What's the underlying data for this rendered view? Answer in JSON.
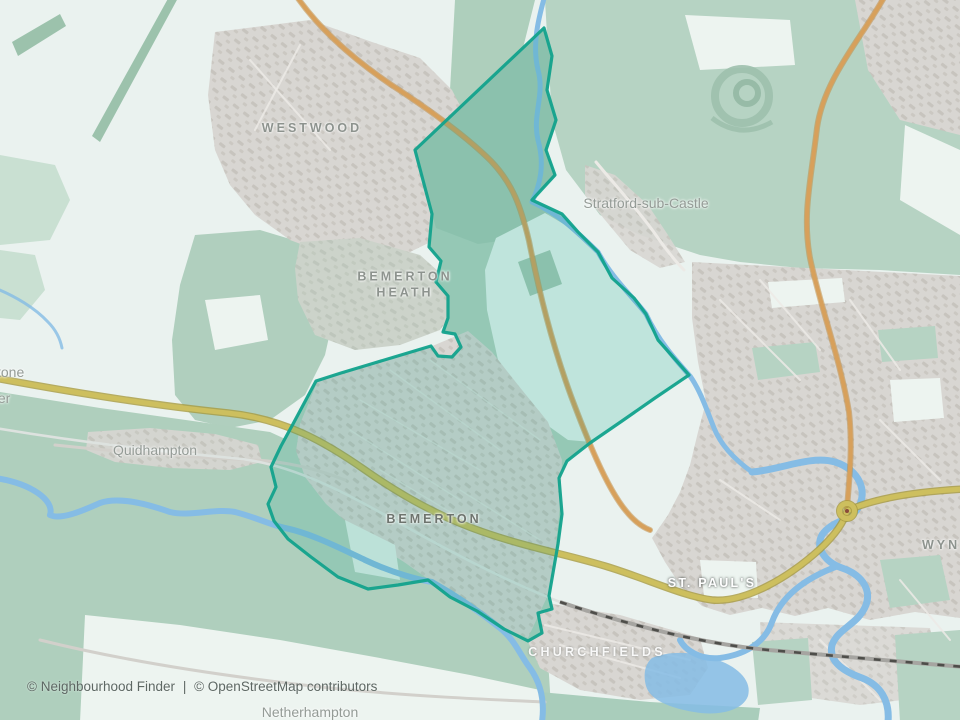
{
  "map": {
    "labels": {
      "westwood": "WESTWOOD",
      "bemerton_heath_1": "BEMERTON",
      "bemerton_heath_2": "HEATH",
      "stratford": "Stratford-sub-Castle",
      "quidhampton": "Quidhampton",
      "bemerton": "BEMERTON",
      "st_pauls": "ST. PAUL'S",
      "churchfields": "CHURCHFIELDS",
      "wyndham": "WYN",
      "netherhampton": "Netherhampton",
      "cut_stone": "stone",
      "cut_ter": "ter"
    },
    "attribution": {
      "brand": "© Neighbourhood Finder",
      "separator": "|",
      "osm": "© OpenStreetMap contributors"
    }
  },
  "colors": {
    "land": "#eaf2ef",
    "green": "#b6d3c3",
    "urban": "#d8d6d2",
    "water": "#85bce5",
    "boundary": "#12a28c",
    "road_primary": "#d7a05b",
    "road_primary_casing": "#c08d44",
    "road_trunk": "#cdbf5e",
    "road_trunk_casing": "#a89a3e",
    "railway": "#a6a5a1",
    "label": "#949b96",
    "label_dark": "#6e746e",
    "label_light": "#ffffff",
    "attribution_text": "#5d6763"
  }
}
